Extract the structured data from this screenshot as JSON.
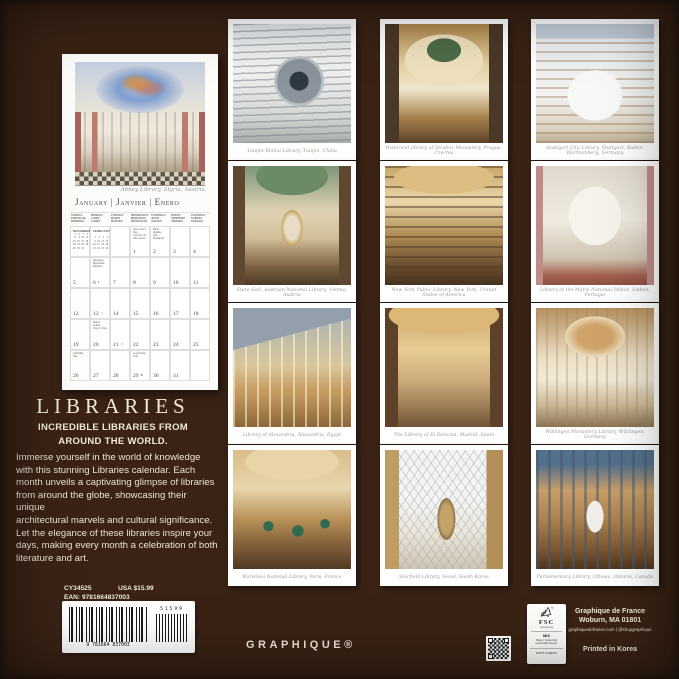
{
  "product": {
    "title": "LIBRARIES",
    "subtitle": "INCREDIBLE LIBRARIES FROM\nAROUND THE WORLD.",
    "description": "Immerse yourself in the world of knowledge\nwith this stunning Libraries calendar. Each\nmonth unveils a captivating glimpse of libraries\nfrom around the globe, showcasing their unique\narchitectural marvels and cultural significance.\nLet the elegance of these libraries inspire your\ndays, making every month a celebration of both\nliterature and art.",
    "sku": "CY34525",
    "ean": "EAN: 9781664837003",
    "price": "USA $15.99",
    "barcode_digits": "9 781664 837003",
    "barcode_supplement": "51599",
    "brand_wordmark": "GRAPHIQUE®"
  },
  "publisher": {
    "line1": "Graphique de France",
    "line2": "Woburn, MA  01801",
    "line3": "graphiquedefrance.com | @shopgraphique",
    "printed_in": "Printed in Korea"
  },
  "fsc": {
    "acronym": "FSC",
    "url": "www.fsc.org",
    "grade": "MIX",
    "claim": "Paper | Supporting\nresponsible forestry",
    "license": "FSC® C139317"
  },
  "calendar": {
    "photo_caption": "Abbey Library, Styria, Austria",
    "month_header": "January | Janvier | Enero",
    "weekdays": [
      "SUNDAY\nDIMANCHE\nDOMINGO",
      "MONDAY\nLUNDI\nLUNES",
      "TUESDAY\nMARDI\nMARTES",
      "WEDNESDAY\nMERCREDI\nMIÉRCOLES",
      "THURSDAY\nJEUDI\nJUEVES",
      "FRIDAY\nVENDREDI\nVIERNES",
      "SATURDAY\nSAMEDI\nSÁBADO"
    ],
    "mini_months": [
      {
        "label": "DECEMBER",
        "grid": " 1  2  3  4  5  6  7\n 8  9 10 11 12 13 14\n15 16 17 18 19 20 21\n22 23 24 25 26 27 28\n29 30 31"
      },
      {
        "label": "FEBRUARY",
        "grid": "                   1\n 2  3  4  5  6  7  8\n 9 10 11 12 13 14 15\n16 17 18 19 20 21 22\n23 24 25 26 27 28"
      }
    ],
    "cells": [
      {
        "day": ""
      },
      {
        "day": ""
      },
      {
        "day": ""
      },
      {
        "day": "1",
        "note": "New Year's Day\nJour de l'An\nAño Nuevo"
      },
      {
        "day": "2",
        "note": "Bank Holiday\n(UK—Scotland)"
      },
      {
        "day": "3"
      },
      {
        "day": "4"
      },
      {
        "day": "5"
      },
      {
        "day": "6",
        "note": "Epiphany\nÉpiphanie\nEpifanía",
        "moon": "◐"
      },
      {
        "day": "7"
      },
      {
        "day": "8"
      },
      {
        "day": "9"
      },
      {
        "day": "10"
      },
      {
        "day": "11"
      },
      {
        "day": "12"
      },
      {
        "day": "13",
        "moon": "○"
      },
      {
        "day": "14"
      },
      {
        "day": "15"
      },
      {
        "day": "16"
      },
      {
        "day": "17"
      },
      {
        "day": "18"
      },
      {
        "day": "19"
      },
      {
        "day": "20",
        "note": "Martin Luther\nKing Jr. Day"
      },
      {
        "day": "21",
        "moon": "◑"
      },
      {
        "day": "22"
      },
      {
        "day": "23"
      },
      {
        "day": "24"
      },
      {
        "day": "25"
      },
      {
        "day": "26",
        "note": "Australia Day"
      },
      {
        "day": "27"
      },
      {
        "day": "28"
      },
      {
        "day": "29",
        "note": "Lunar New Year",
        "moon": "●"
      },
      {
        "day": "30"
      },
      {
        "day": "31"
      },
      {
        "day": ""
      }
    ]
  },
  "thumbnails": [
    {
      "caption": "Tianjin Binhai Library, Tianjin, China"
    },
    {
      "caption": "Historical library of Strahov Monastery, Prague, Czechia"
    },
    {
      "caption": "Stuttgart City Library, Stuttgart, Baden-Württemberg, Germany"
    },
    {
      "caption": "State Hall, Austrian National Library, Vienna, Austria"
    },
    {
      "caption": "New York Public Library, New York, United States of America"
    },
    {
      "caption": "Library of the Mafra National Palace, Lisbon, Portugal"
    },
    {
      "caption": "Library of Alexandria, Alexandria, Egypt"
    },
    {
      "caption": "The Library of El Escorial, Madrid, Spain"
    },
    {
      "caption": "Wiblingen Monastery Library, Wiblingen, Germany"
    },
    {
      "caption": "Richelieu National Library, Paris, France"
    },
    {
      "caption": "Starfield Library, Seoul, South Korea"
    },
    {
      "caption": "Parliamentary Library, Ottawa, Ontario, Canada"
    }
  ]
}
